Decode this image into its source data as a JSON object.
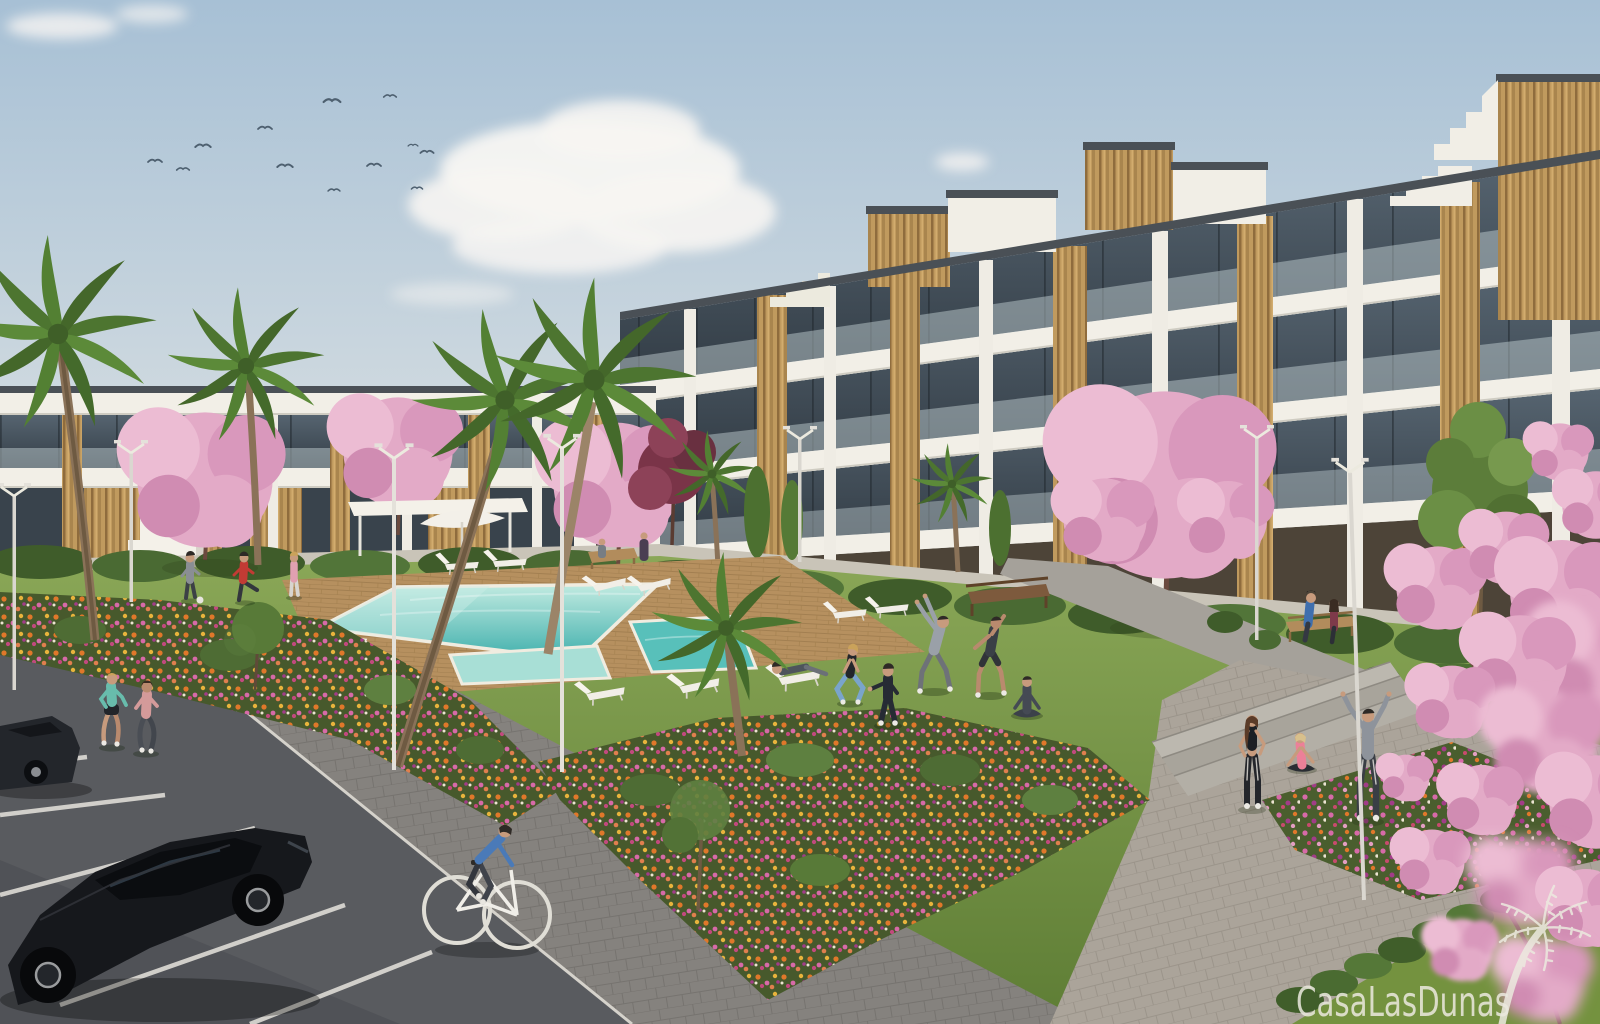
{
  "image": {
    "kind": "3D architectural render",
    "subject": "Modern white apartment complex with communal pool, landscaped gardens, lawn, parking area and residents outdoors",
    "watermark": {
      "text": "CasaLasDunas",
      "logo": "palm-tree-logo"
    }
  },
  "scene": {
    "sky": "clear pale-blue sky with soft cumulus clouds and a flock of birds upper-left",
    "buildings": "white flat-roofed apartment blocks, 2-4 storeys, glass balcony balustrades, dark roof trim, vertical wood-clad accent panels, rooftop penthouse volumes and stepped parapets",
    "amenities": [
      "turquoise swimming pool",
      "jacuzzi pool",
      "kids pool",
      "timber pool deck",
      "white sun loungers",
      "white parasol",
      "pergola canopy",
      "wooden benches",
      "modern street lamps",
      "paved walkways",
      "steps"
    ],
    "vegetation": [
      "palm trees",
      "pink blossom trees",
      "maroon ornamental tree",
      "green young tree",
      "flower beds with orange and magenta flowers",
      "clipped hedges",
      "lawn"
    ],
    "activity": [
      "two joggers",
      "cyclist on white bicycle",
      "group doing outdoor exercise and stretching",
      "woman doing yoga",
      "couple seated on bench",
      "people playing with a ball",
      "person relaxing on deck chair"
    ],
    "vehicles": "black cars parked in angled parking bays with white line markings",
    "counts": {
      "birds": 12,
      "people": 17,
      "cars": 2,
      "palm_trees": 7,
      "blossom_trees": 6,
      "street_lamps": 7,
      "sun_loungers": 10,
      "benches": 3,
      "pools": 3
    }
  },
  "colors": {
    "sky_top": "#a7c0d5",
    "sky_horizon": "#e3e6e5",
    "cloud_white": "#f7f5f2",
    "building_white": "#f2efe7",
    "roof_trim": "#4a5056",
    "glass_dark": "#323c45",
    "wood_tan": "#c09a5e",
    "grass_light": "#8aa757",
    "grass_dark": "#5e7d35",
    "hedge_green": "#3f5c2a",
    "pool_light": "#c2ebe1",
    "pool_deep": "#3fafac",
    "deck_wood": "#b6905f",
    "path_gray": "#85827e",
    "pavement_beige": "#aba49a",
    "asphalt_gray": "#595b5f",
    "flower_orange": "#e0782a",
    "flower_magenta": "#a23c88",
    "flower_pink": "#d76aa8",
    "blossom_pink": "#e3aac7",
    "watermark_cream": "#eceadf",
    "car_black": "#16181c",
    "skin_tone": "#c79b7d"
  }
}
